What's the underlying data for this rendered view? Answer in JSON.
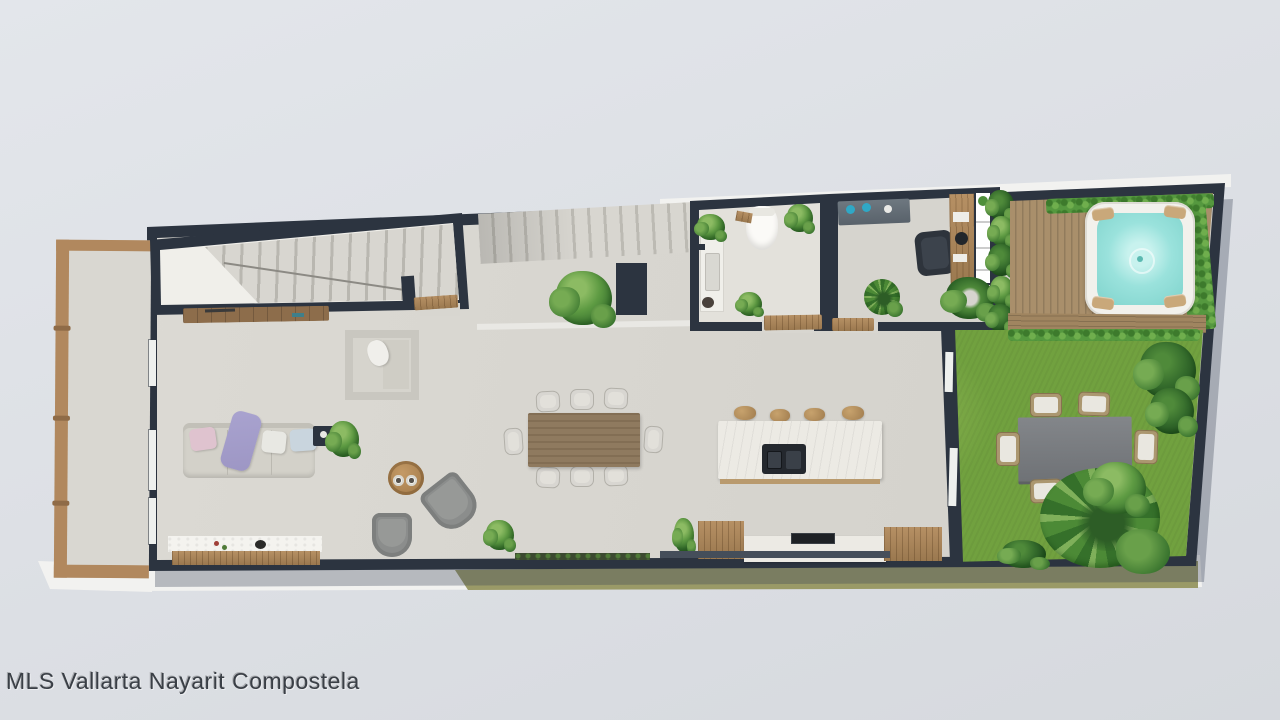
{
  "scene": {
    "watermark": "MLS Vallarta Nayarit Compostela"
  },
  "colors": {
    "background_top": "#e3e6eb",
    "background_bottom": "#d6d9de",
    "wall_dark": "#2c3440",
    "floor_light": "#d8d6d0",
    "floor_pale": "#f0efea",
    "room_floor": "#e3e1db",
    "terrace_floor": "#d9d7d1",
    "wood_frame": "#b1885e",
    "wood_dark": "#8d6d4b",
    "deck_wood": "#a98f6b",
    "grass": "#71a13f",
    "hedge": "#55983f",
    "water": "#9ae2dc",
    "tub_shell": "#f2f1ec",
    "marble": "#eceae4",
    "sink_dark": "#24282e",
    "sofa": "#d3d1c9",
    "pillow_pink": "#dfc3cf",
    "pillow_purple": "#9d96c4",
    "pillow_blue": "#c9d5de",
    "chair_gray": "#8b8d8c",
    "dining_wood": "#8f7a5f",
    "stool_wood": "#b2905f",
    "outdoor_table": "#7b7e80",
    "wicker": "#ab9770",
    "cushion": "#e9e7e0",
    "teal_accent": "#2fa8c6",
    "khaki_trim": "#9a9a67",
    "trim_white": "#f2f2f0",
    "watermark": "#3a3f46"
  }
}
